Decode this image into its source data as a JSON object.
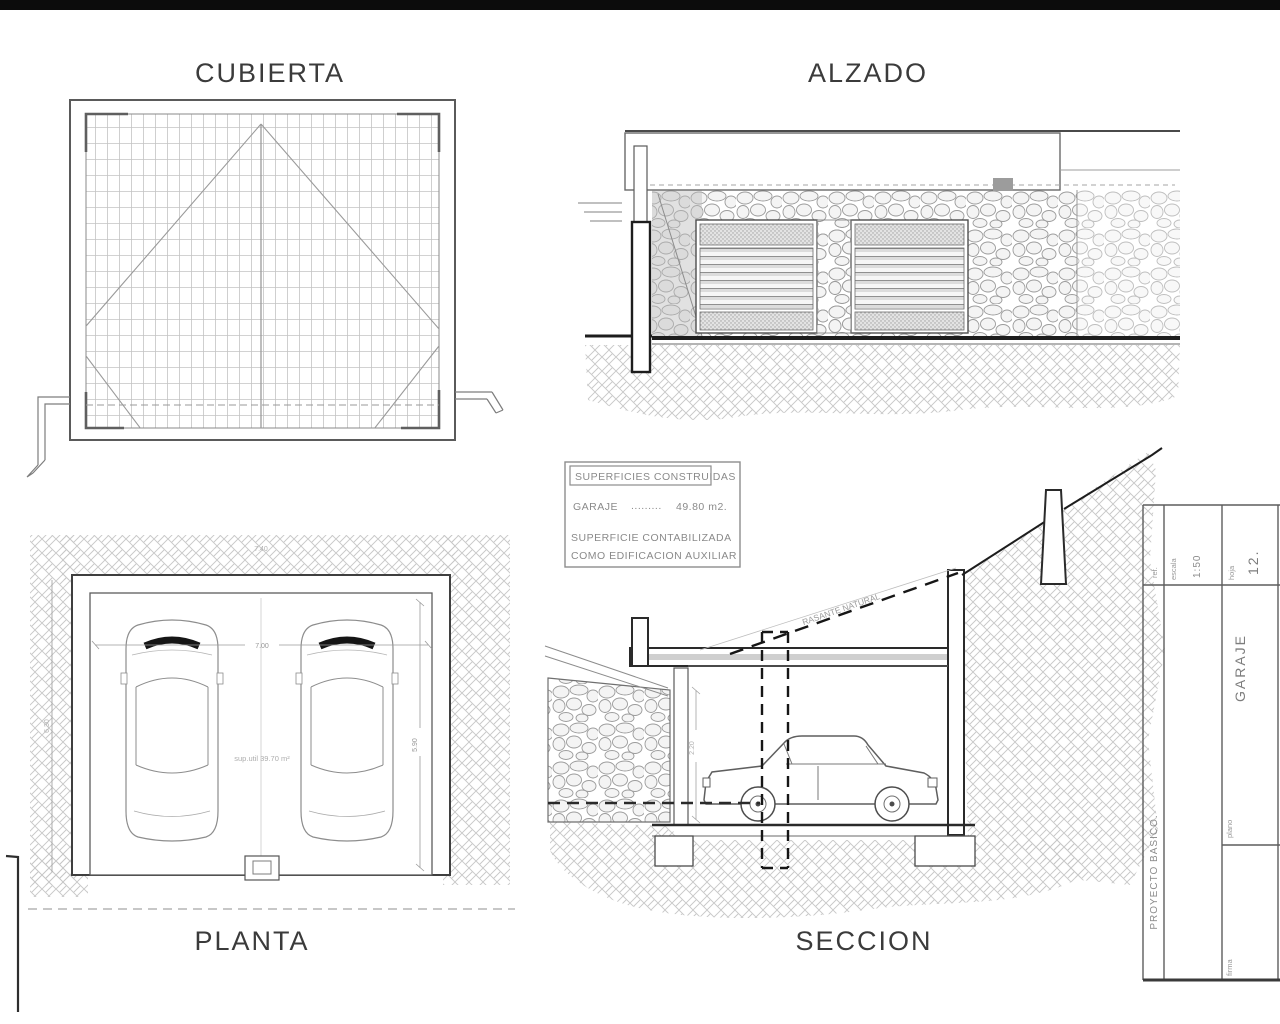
{
  "views": {
    "cubierta": {
      "title": "CUBIERTA"
    },
    "alzado": {
      "title": "ALZADO"
    },
    "planta": {
      "title": "PLANTA",
      "sup_util": "sup.util 39.70 m²",
      "dims": {
        "inner_width": "7.00",
        "outer_width": "7.40",
        "inner_depth": "5.90",
        "outer_depth": "6.30"
      }
    },
    "seccion": {
      "title": "SECCION",
      "rasante_label": "RASANTE NATURAL",
      "dims": {
        "clear_height": "2.20"
      }
    }
  },
  "notes": {
    "header": "SUPERFICIES CONSTRUIDAS",
    "garaje_label": "GARAJE",
    "leader_dots": ".........",
    "garaje_value": "49.80 m2.",
    "note_line1": "SUPERFICIE CONTABILIZADA",
    "note_line2": "COMO EDIFICACION AUXILIAR"
  },
  "titleblock": {
    "ref_label": "ref.",
    "escala_label": "escala",
    "escala_value": "1:50",
    "hoja_label": "hoja",
    "hoja_value": "12.",
    "plano_label": "plano",
    "plano_value": "GARAJE",
    "fase_value": "PROYECTO BASICO.",
    "firma_label": "firma"
  }
}
